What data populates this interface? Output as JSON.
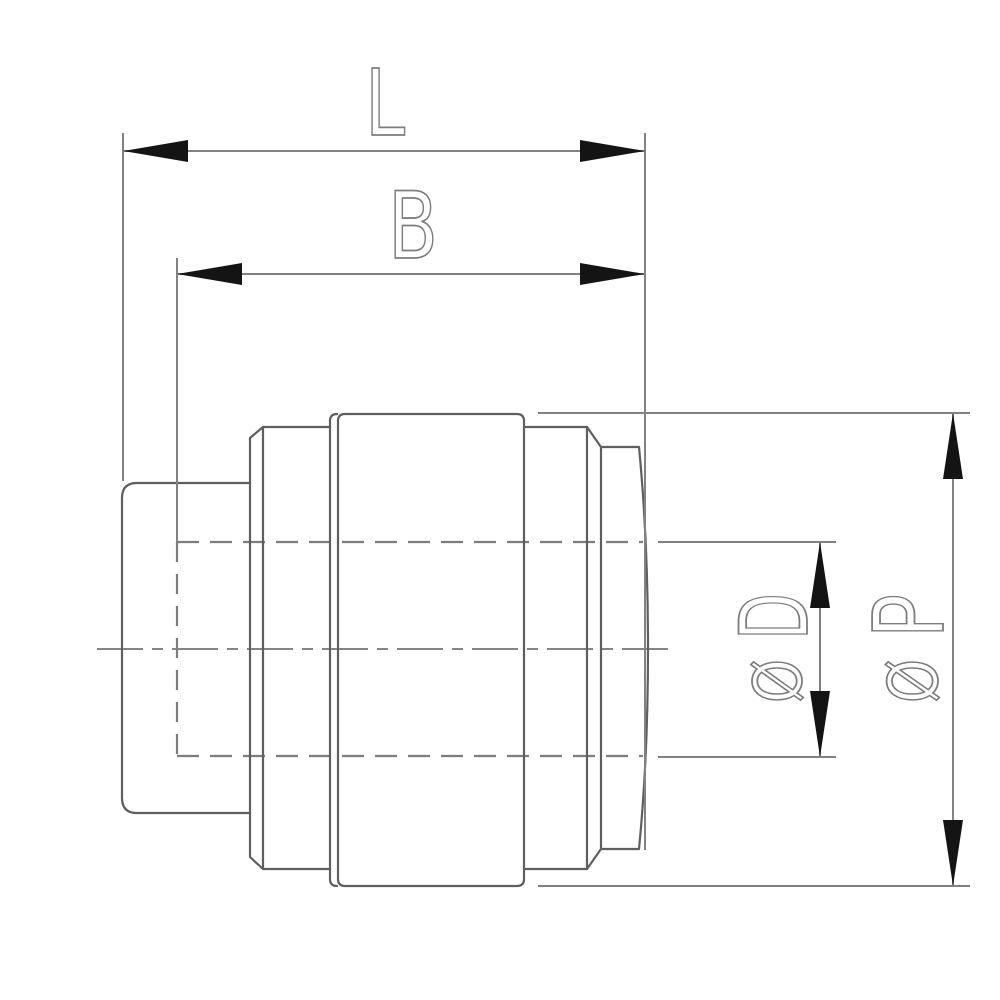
{
  "drawing": {
    "title": "pipe-fitting-end-cap-dimension-drawing",
    "labels": {
      "overall_length": "L",
      "body_length": "B",
      "bore_diameter": {
        "symbol": "Ø",
        "letter": "D"
      },
      "outer_diameter": {
        "symbol": "Ø",
        "letter": "P"
      }
    },
    "colors": {
      "background": "#ffffff",
      "outline": "#5f5f5f",
      "dimension_lines": "#828282",
      "hidden_lines": "#7d7d7d",
      "center_line": "#858585",
      "label_stroke": "#7d7d7d",
      "arrowheads": "#141414"
    }
  }
}
